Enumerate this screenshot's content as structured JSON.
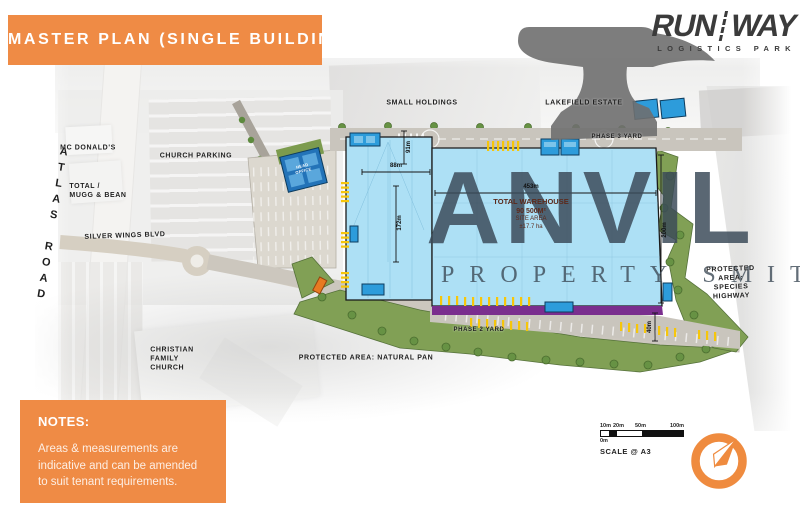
{
  "banner": {
    "title": "MASTER PLAN (SINGLE BUILDING)"
  },
  "logo": {
    "word1": "RUN",
    "word2": "WAY",
    "tagline": "LOGISTICS PARK"
  },
  "watermark": {
    "name": "ANVIL",
    "sub": "PROPERTY SMITH"
  },
  "plan": {
    "context": {
      "small_holdings": "SMALL HOLDINGS",
      "lakefield_estate": "LAKEFIELD ESTATE",
      "mcdonalds": "MC DONALD'S",
      "church_parking": "CHURCH PARKING",
      "total_mugg_bean": "TOTAL /\nMUGG & BEAN",
      "atlas_road": "ATLAS ROAD",
      "silver_wings_blvd": "SILVER WINGS BLVD",
      "christian_family_church": "CHRISTIAN\nFAMILY\nCHURCH",
      "protected_natural_pan": "PROTECTED AREA: NATURAL PAN",
      "protected_species_highway": "PROTECTED AREA:\nSPECIES HIGHWAY",
      "phase2_yard": "PHASE 2 YARD",
      "phase3_yard": "PHASE 3 YARD",
      "head_office": "HEAD\nOFFICE"
    },
    "warehouse": {
      "title": "TOTAL WAREHOUSE",
      "area": "90 500M²",
      "site_label": "SITE AREA",
      "site_area": "±17.7 ha"
    },
    "dimensions": {
      "w88": "88m",
      "h91": "91m",
      "h172": "172m",
      "w453": "453m",
      "h200": "200m",
      "h40": "40m"
    }
  },
  "notes": {
    "heading": "NOTES:",
    "body": "Areas & measurements are indicative and can be amended to suit tenant requirements."
  },
  "scale": {
    "m10": "10m",
    "m20": "20m",
    "m50": "50m",
    "m100": "100m",
    "m0": "0m",
    "caption": "SCALE @ A3"
  },
  "colors": {
    "accent": "#EF8B45",
    "warehouse_blue": "#ADE0F5",
    "dock_blue": "#2D9CDB",
    "phase_purple": "#7A2E8E",
    "marking_yellow": "#F6C60A",
    "landscape_green": "#81A055",
    "watermark_slate": "#3E4F5C"
  }
}
